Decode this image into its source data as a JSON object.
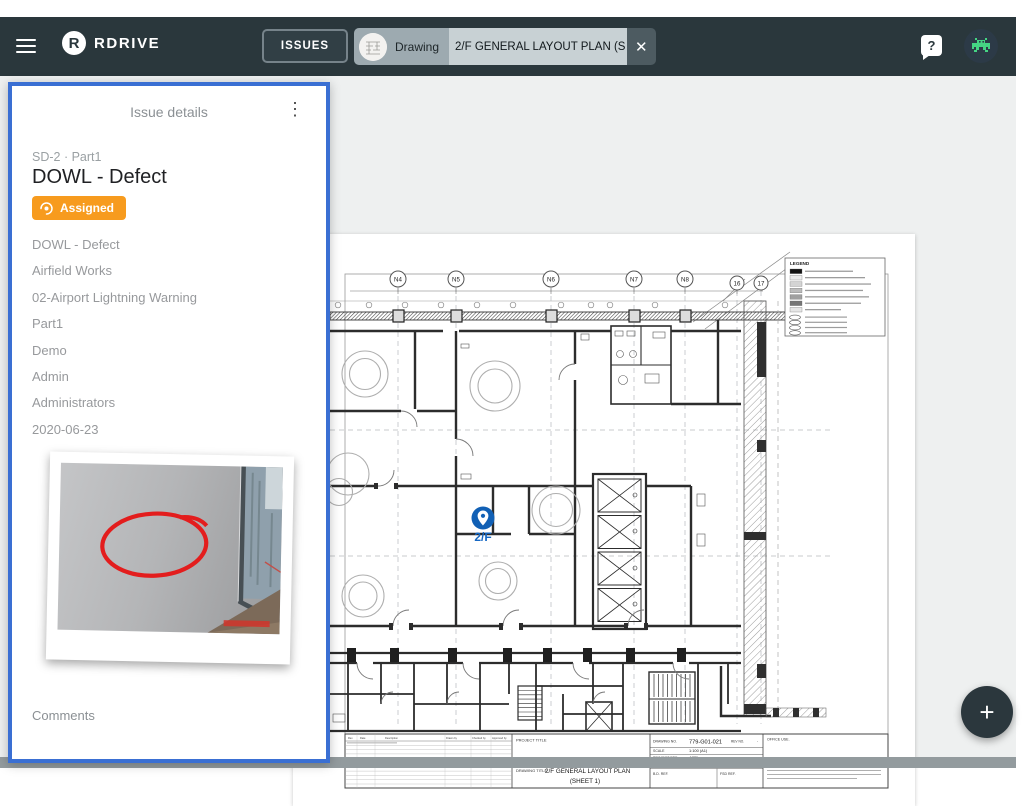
{
  "topbar": {
    "brand": "RDRIVE",
    "brand_initial": "R",
    "issues_button_label": "ISSUES",
    "tab_type_label": "Drawing",
    "tab_title": "2/F GENERAL LAYOUT PLAN (S",
    "close_icon": "✕",
    "help_icon": "?"
  },
  "issue_panel": {
    "header": "Issue details",
    "menu_icon": "⋮",
    "reference": "SD-2 · Part1",
    "title": "DOWL - Defect",
    "status_label": "Assigned",
    "fields": [
      "DOWL - Defect",
      "Airfield Works",
      "02-Airport Lightning Warning",
      "Part1",
      "Demo",
      "Admin",
      "Administrators",
      "2020-06-23"
    ],
    "comments_label": "Comments"
  },
  "drawing": {
    "pin_label": "2/F",
    "grid_labels": [
      "N4",
      "N5",
      "N6",
      "N7",
      "N8",
      "16",
      "17"
    ],
    "legend_title": "LEGEND",
    "titleblock": {
      "project_title_label": "PROJECT TITLE",
      "drawing_title_label": "DRAWING TITLE",
      "drawing_title": "2/F GENERAL LAYOUT PLAN",
      "sheet_label": "(SHEET 1)",
      "drawing_no_label": "DRAWING NO.",
      "drawing_no": "779-G01-021",
      "rev_no_label": "REV NO.",
      "rev_no": "-",
      "scale_label": "SCALE",
      "scale_value": "1:100 (A1)",
      "project_ref_label": "PROJECT REF.",
      "project_ref": "A779",
      "cad_ref_label": "CAD REF.",
      "cad_ref": "779-G01-021_E03.dwg",
      "bd_ref_label": "B.D. REF.",
      "fsd_ref_label": "FSD REF.",
      "office_use_label": "OFFICE USE.",
      "rev_headers": [
        "Rev",
        "Date",
        "Description",
        "Drawn by",
        "Checked by",
        "Approved by"
      ]
    }
  },
  "fab": {
    "plus_icon": "+"
  },
  "colors": {
    "topbar": "#2a373c",
    "accent_blue": "#3a6fd3",
    "badge_orange": "#f79b1e",
    "pin_blue": "#1160b5",
    "avatar_green": "#45d483"
  }
}
